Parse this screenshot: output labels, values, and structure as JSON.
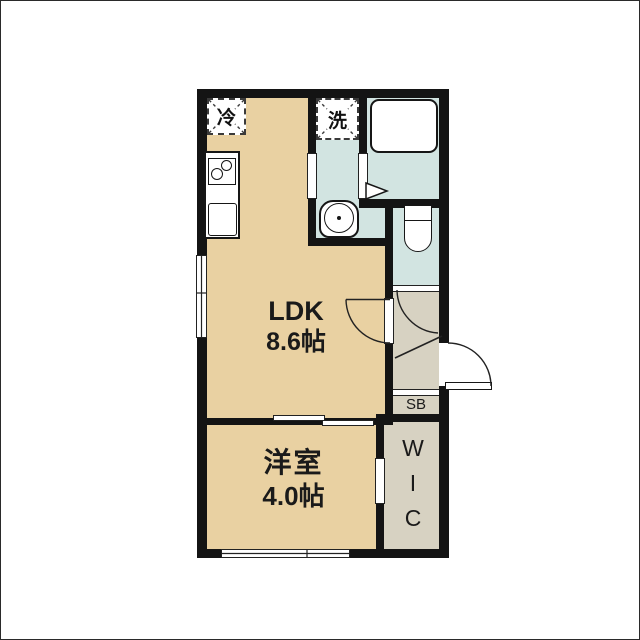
{
  "plan": {
    "title": "1LDK apartment floor plan",
    "rooms": {
      "ldk": {
        "label": "LDK",
        "area": "8.6帖"
      },
      "yoshitsu": {
        "label": "洋室",
        "area": "4.0帖"
      },
      "wic": {
        "label": "WIC"
      },
      "shoebox": {
        "label": "SB"
      }
    },
    "fixtures": {
      "refrigerator": {
        "label": "冷"
      },
      "washer": {
        "label": "洗"
      }
    },
    "colors": {
      "room_tan": "#e9d1a2",
      "wet_blue": "#d2e4e1",
      "hall_beige": "#d7d2c2",
      "wall_black": "#141414",
      "background": "#ffffff"
    }
  }
}
